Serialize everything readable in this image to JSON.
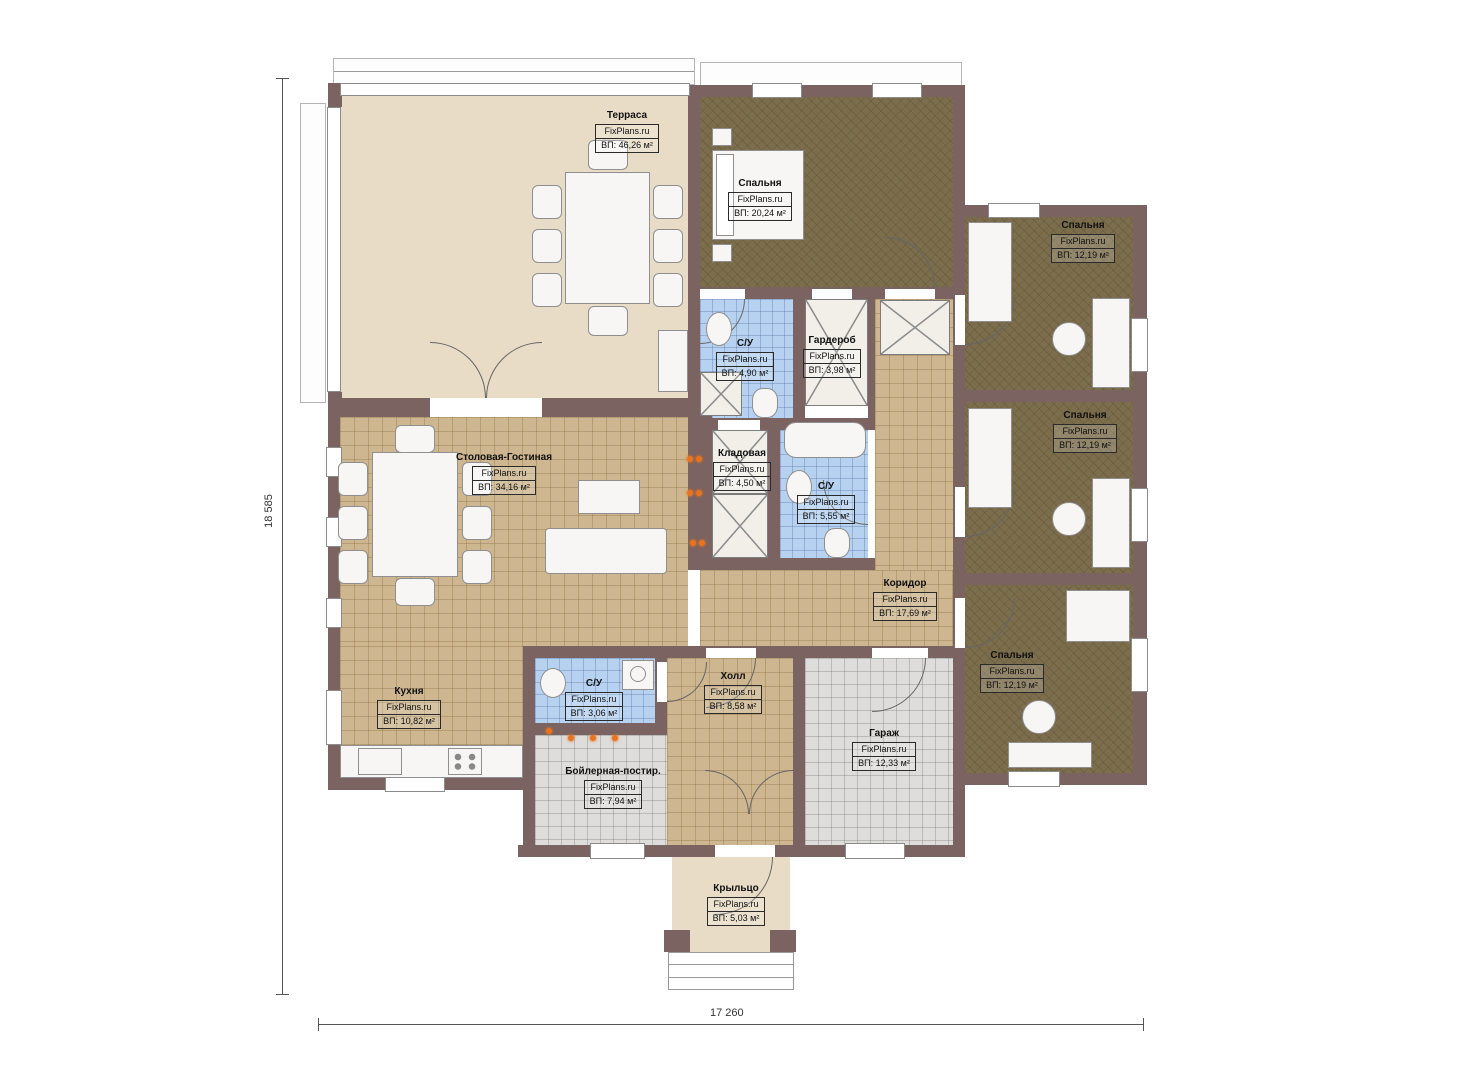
{
  "plan": {
    "brand": "FixPlans.ru",
    "area_prefix": "ВП:",
    "dimensions": {
      "height_label": "18 585",
      "width_label": "17 260"
    },
    "rooms": {
      "terrace": {
        "name": "Терраса",
        "area": "ВП: 46,26 м²"
      },
      "bedroom_master": {
        "name": "Спальня",
        "area": "ВП: 20,24 м²"
      },
      "bedroom_top_right": {
        "name": "Спальня",
        "area": "ВП: 12,19 м²"
      },
      "bedroom_mid_right": {
        "name": "Спальня",
        "area": "ВП: 12,19 м²"
      },
      "bedroom_bot_right": {
        "name": "Спальня",
        "area": "ВП: 12,19 м²"
      },
      "bathroom_top": {
        "name": "С/У",
        "area": "ВП: 4,90 м²"
      },
      "wardrobe": {
        "name": "Гардероб",
        "area": "ВП: 3,98 м²"
      },
      "storage": {
        "name": "Кладовая",
        "area": "ВП: 4,50 м²"
      },
      "bathroom_mid": {
        "name": "С/У",
        "area": "ВП: 5,55 м²"
      },
      "living": {
        "name": "Столовая-Гостиная",
        "area": "ВП: 34,16 м²"
      },
      "corridor": {
        "name": "Коридор",
        "area": "ВП: 17,69 м²"
      },
      "kitchen": {
        "name": "Кухня",
        "area": "ВП: 10,82 м²"
      },
      "bathroom_small": {
        "name": "С/У",
        "area": "ВП: 3,06 м²"
      },
      "hall": {
        "name": "Холл",
        "area": "ВП: 8,58 м²"
      },
      "garage": {
        "name": "Гараж",
        "area": "ВП: 12,33 м²"
      },
      "boiler": {
        "name": "Бойлерная-постир.",
        "area": "ВП: 7,94 м²"
      },
      "porch": {
        "name": "Крыльцо",
        "area": "ВП: 5,03 м²"
      }
    },
    "colors": {
      "wall": "#7a6361",
      "floor_wood": "#cdb690",
      "floor_carpet": "#7c6d4c",
      "floor_tile_blue": "#b7d2f0",
      "floor_tile_gray": "#dedddb",
      "floor_terrace": "#e8dcc6",
      "accent_fire": "#e8741f"
    }
  }
}
